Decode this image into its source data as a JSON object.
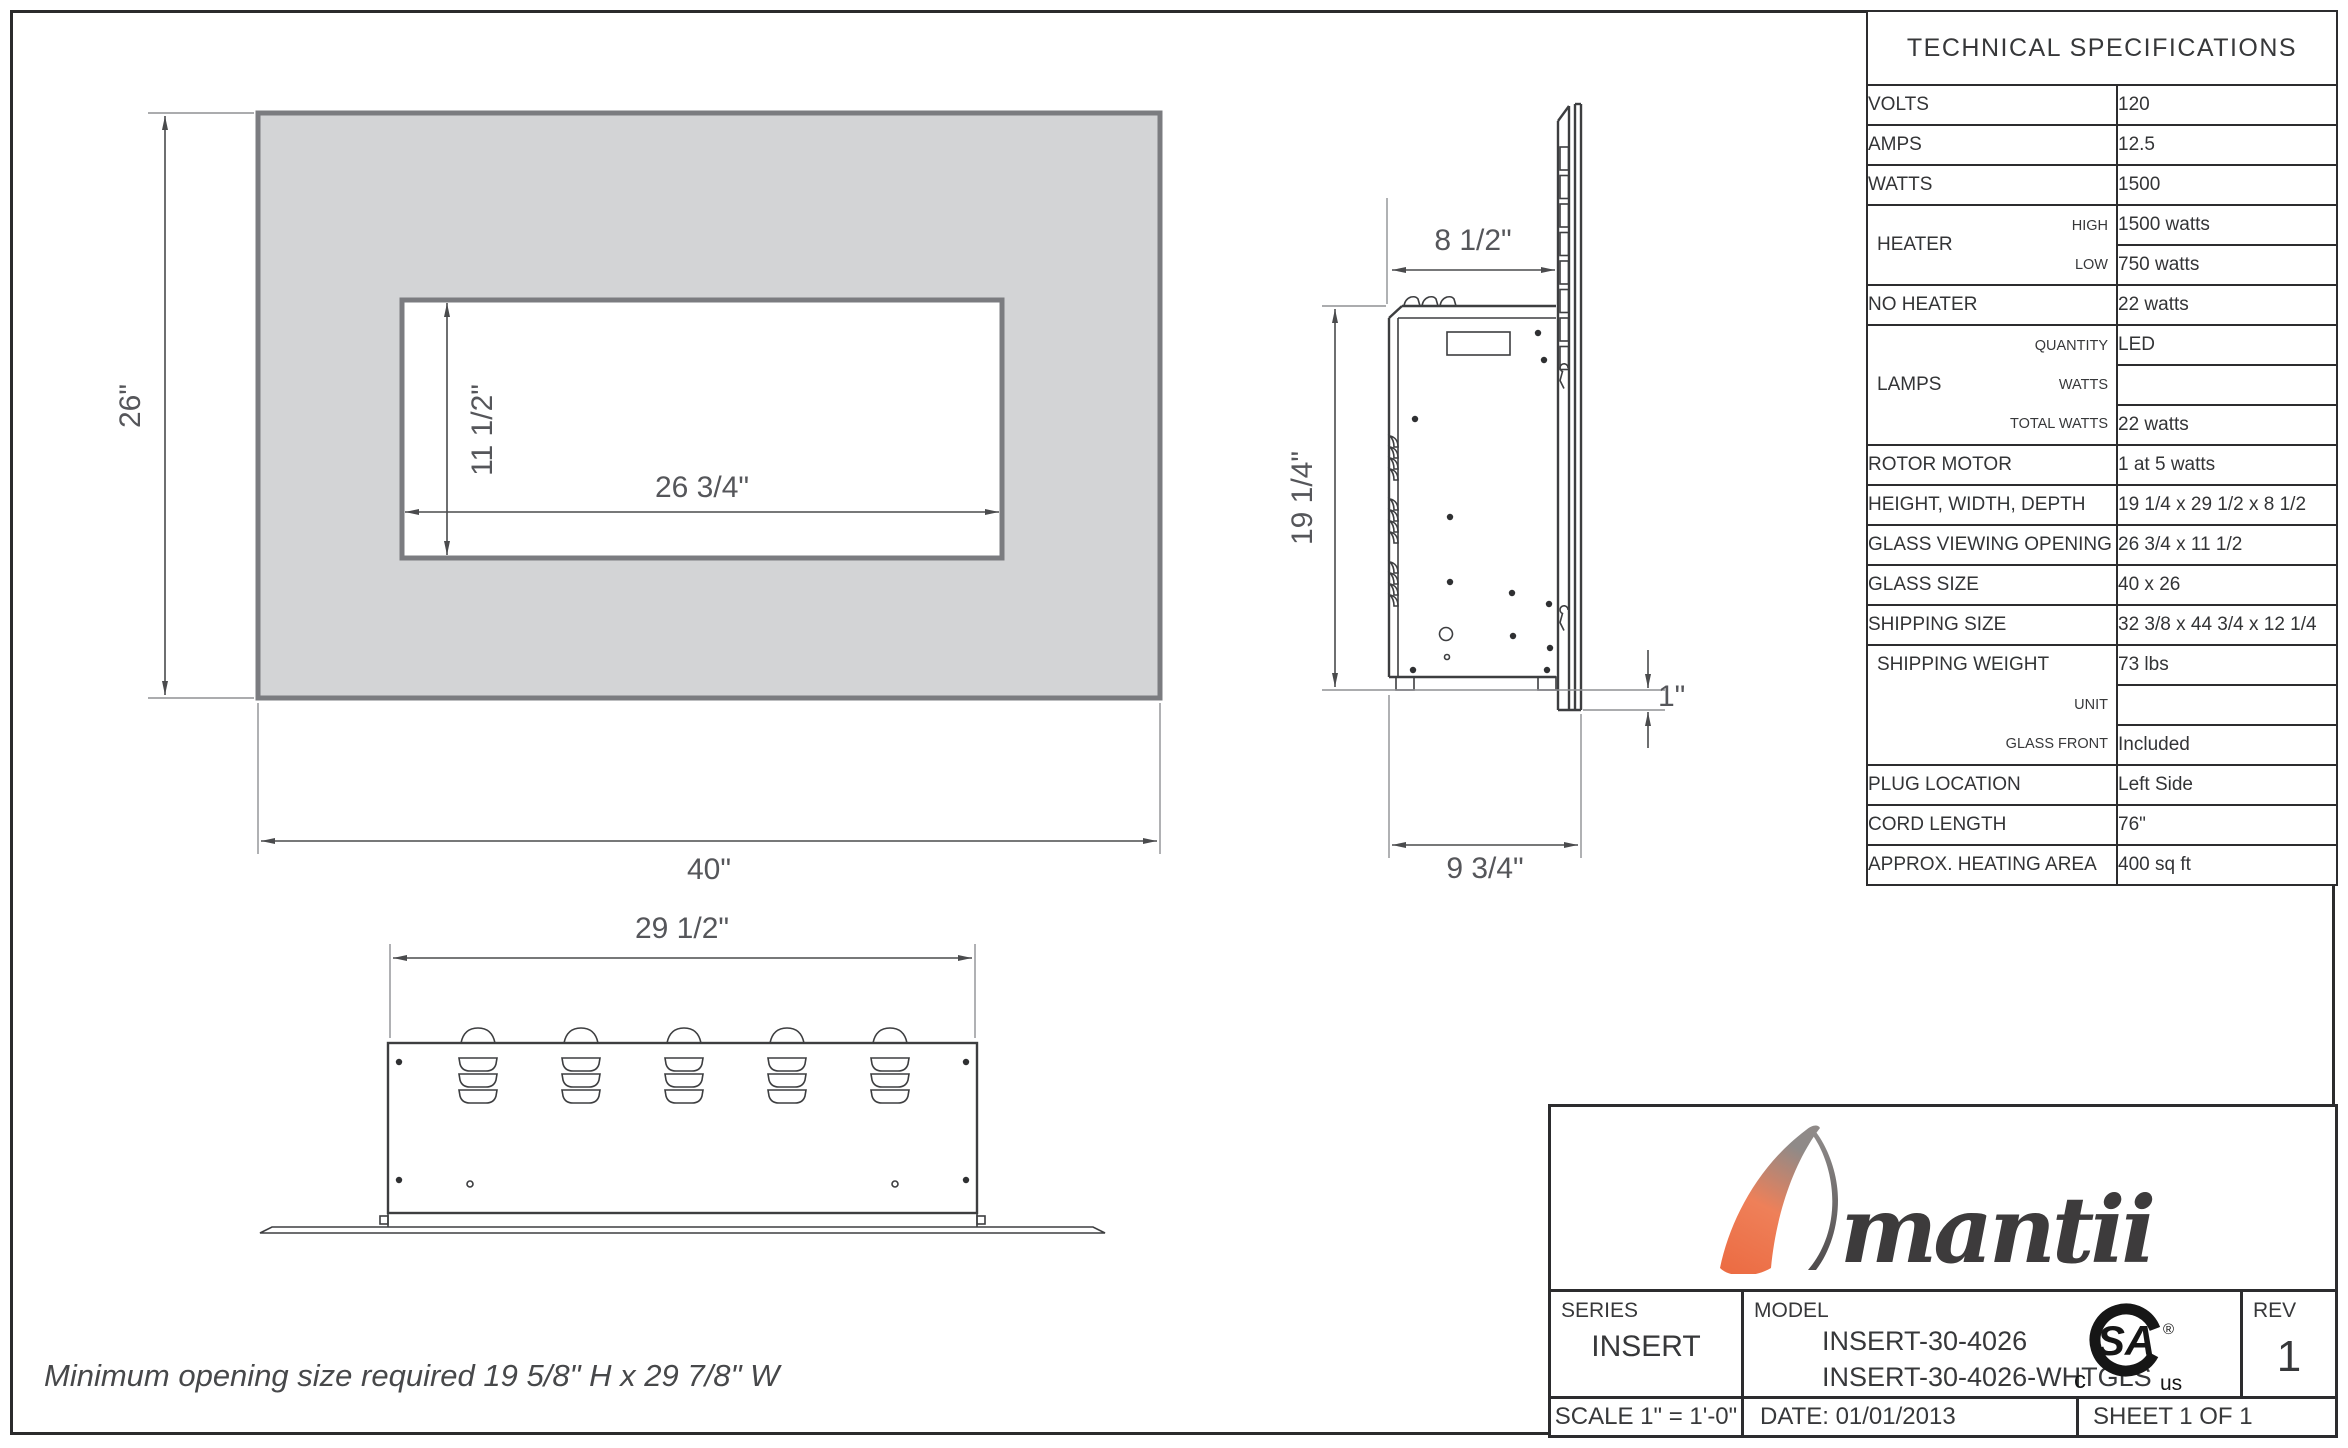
{
  "sheet": {
    "note": "Minimum opening size required 19 5/8\" H x 29 7/8\" W"
  },
  "front_view": {
    "overall_height": "26\"",
    "overall_width": "40\"",
    "opening_height": "11 1/2\"",
    "opening_width": "26 3/4\""
  },
  "side_view": {
    "top_depth": "8 1/2\"",
    "height": "19 1/4\"",
    "glass_drop": "1\"",
    "base_depth": "9 3/4\""
  },
  "bottom_view": {
    "width": "29 1/2\""
  },
  "specs": {
    "title": "TECHNICAL SPECIFICATIONS",
    "groups": [
      {
        "label": "VOLTS",
        "rows": [
          {
            "value": "120"
          }
        ]
      },
      {
        "label": "AMPS",
        "rows": [
          {
            "value": "12.5"
          }
        ]
      },
      {
        "label": "WATTS",
        "rows": [
          {
            "value": "1500"
          }
        ]
      },
      {
        "label": "HEATER",
        "rows": [
          {
            "sub": "HIGH",
            "value": "1500 watts"
          },
          {
            "sub": "LOW",
            "value": "750 watts"
          }
        ]
      },
      {
        "label": "NO HEATER",
        "rows": [
          {
            "value": "22 watts"
          }
        ]
      },
      {
        "label": "LAMPS",
        "rows": [
          {
            "sub": "QUANTITY",
            "value": "LED"
          },
          {
            "sub": "WATTS",
            "value": ""
          },
          {
            "sub": "TOTAL WATTS",
            "value": "22 watts"
          }
        ]
      },
      {
        "label": "ROTOR MOTOR",
        "rows": [
          {
            "value": "1 at 5 watts"
          }
        ]
      },
      {
        "label": "HEIGHT, WIDTH, DEPTH",
        "rows": [
          {
            "value": "19 1/4 x 29 1/2 x 8 1/2"
          }
        ]
      },
      {
        "label": "GLASS VIEWING OPENING",
        "rows": [
          {
            "value": "26 3/4 x 11 1/2"
          }
        ]
      },
      {
        "label": "GLASS SIZE",
        "rows": [
          {
            "value": "40 x 26"
          }
        ]
      },
      {
        "label": "SHIPPING SIZE",
        "rows": [
          {
            "value": "32 3/8 x 44 3/4 x 12 1/4"
          }
        ]
      },
      {
        "label": "SHIPPING WEIGHT",
        "rows": [
          {
            "sub": "",
            "value": "73 lbs"
          },
          {
            "sub": "UNIT",
            "value": ""
          },
          {
            "sub": "GLASS FRONT",
            "value": "Included"
          }
        ]
      },
      {
        "label": "PLUG LOCATION",
        "rows": [
          {
            "value": "Left Side"
          }
        ]
      },
      {
        "label": "CORD LENGTH",
        "rows": [
          {
            "value": "76\""
          }
        ]
      },
      {
        "label": "APPROX. HEATING AREA",
        "rows": [
          {
            "value": "400 sq ft"
          }
        ]
      }
    ]
  },
  "title_block": {
    "brand": "Amantii",
    "logo_rest": "mantii",
    "series_label": "SERIES",
    "series_value": "INSERT",
    "model_label": "MODEL",
    "model_line1": "INSERT-30-4026",
    "model_line2": "INSERT-30-4026-WHTGLS",
    "rev_label": "REV",
    "rev_value": "1",
    "scale": "SCALE 1\" = 1'-0\"",
    "date": "DATE: 01/01/2013",
    "sheet": "SHEET 1 OF 1",
    "csa_mark": "SA",
    "csa_c": "c",
    "csa_us": "us",
    "csa_reg": "®"
  }
}
